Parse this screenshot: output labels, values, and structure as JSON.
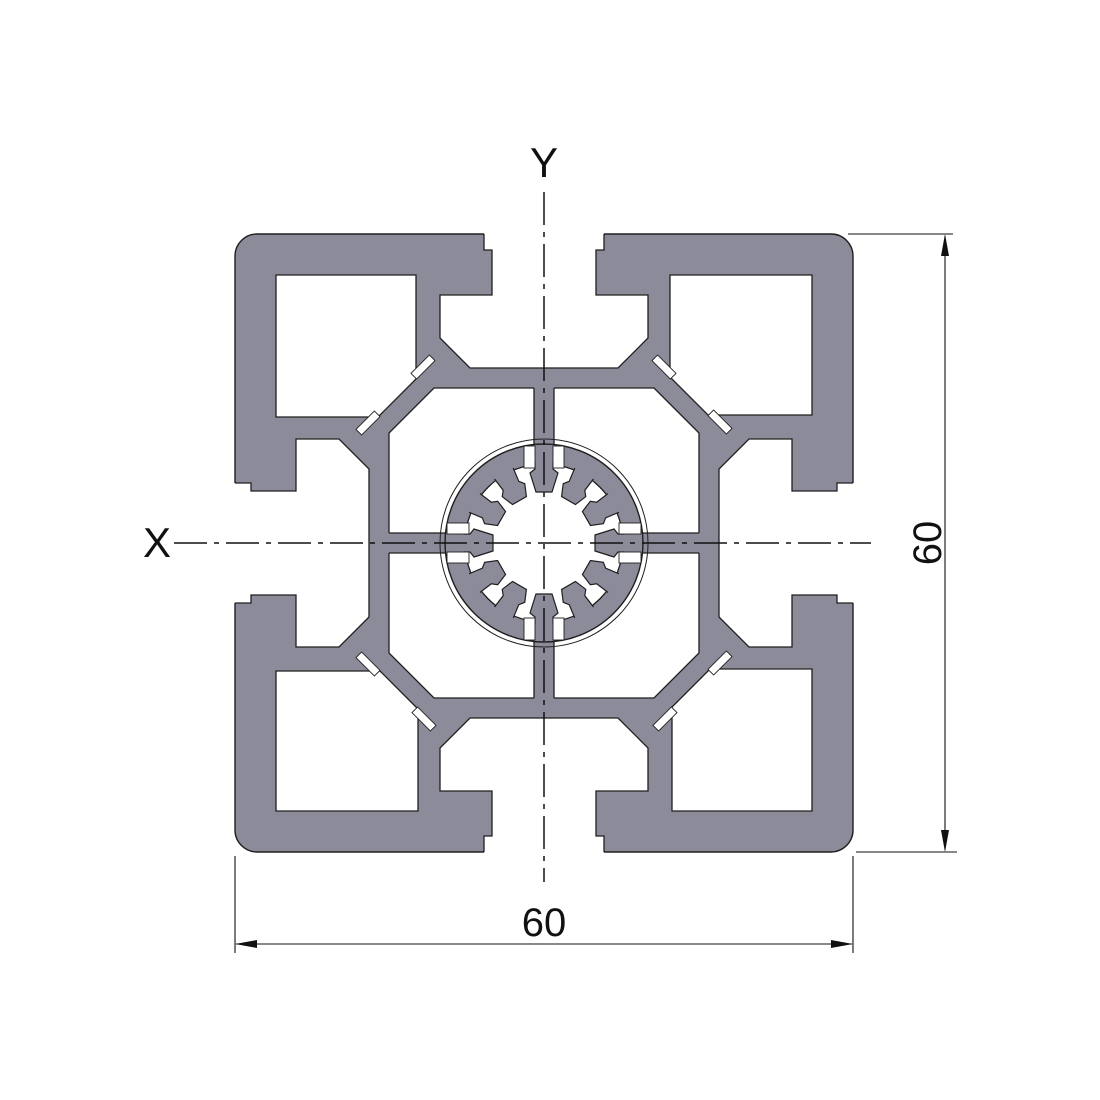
{
  "drawing": {
    "axis_labels": {
      "x": "X",
      "y": "Y"
    },
    "dimensions": {
      "width": "60",
      "height": "60"
    },
    "colors": {
      "profile_fill": "#8B8B9A",
      "outline": "#1F1F1F",
      "background": "#FFFFFF",
      "dimension_line": "#111111"
    }
  }
}
